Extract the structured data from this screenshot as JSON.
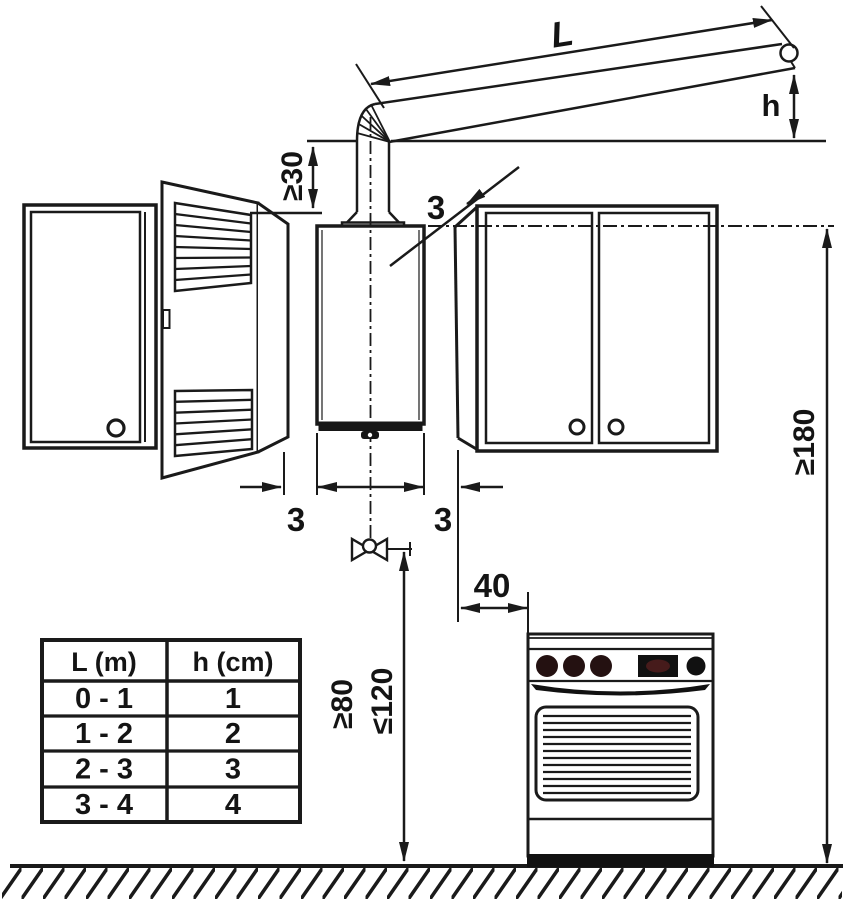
{
  "diagram": {
    "dims": {
      "flue_horizontal_length": "L",
      "flue_end_drop": "h",
      "flue_vertical_min": "≥30",
      "gap_boiler_to_cabinet": "3",
      "gap_left_cabinet": "3",
      "gap_right_cabinet": "3",
      "cooker_side_clearance": "40",
      "valve_height_min": "≥80",
      "valve_height_max": "≤120",
      "reference_height_min": "≥180"
    },
    "table": {
      "headers": [
        "L (m)",
        "h (cm)"
      ],
      "rows": [
        {
          "L": "0 - 1",
          "h": "1"
        },
        {
          "L": "1 - 2",
          "h": "2"
        },
        {
          "L": "2 - 3",
          "h": "3"
        },
        {
          "L": "3 - 4",
          "h": "4"
        }
      ]
    },
    "colors": {
      "line": "#1a1a1a",
      "background": "#ffffff"
    }
  }
}
